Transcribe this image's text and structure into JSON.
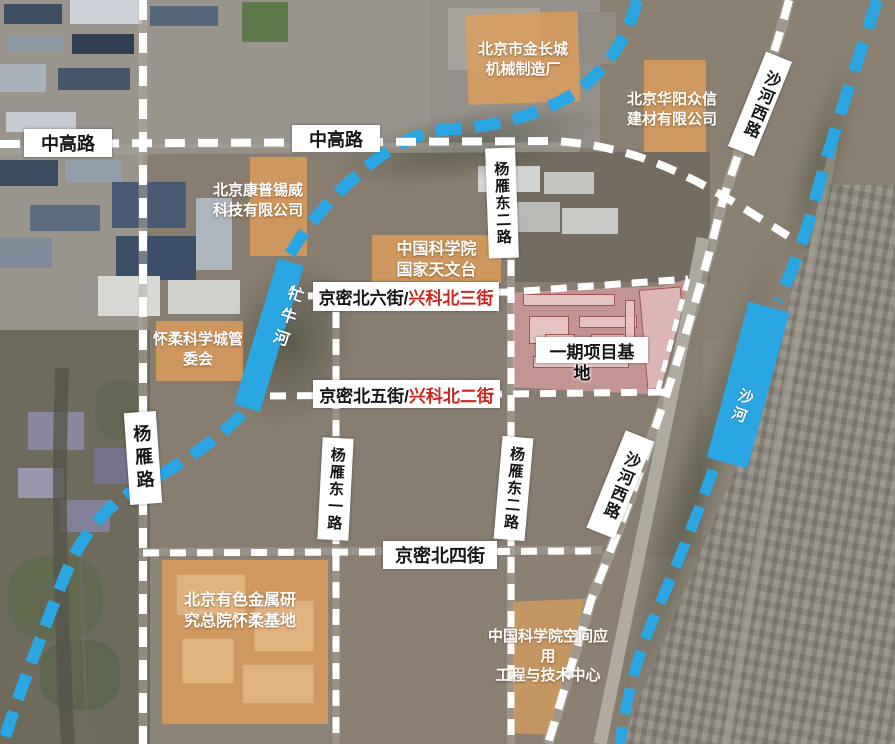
{
  "colors": {
    "river_blue": "#2aa7e3",
    "highlight_orange": "#e09e5a",
    "project_pink": "#d5a0a0",
    "road_label_red": "#c8281e",
    "road_dash_white": "#ffffff"
  },
  "road_labels": {
    "zhonggao_left": "中高路",
    "zhonggao_right": "中高路",
    "shahe_west_top": "沙河西路",
    "shahe_west_bottom": "沙河西路",
    "yangyan_dong_er_top": "杨雁东二路",
    "yangyan_dong_er_bottom": "杨雁东二路",
    "yangyan_dong_yi": "杨雁东一路",
    "yangyan": "杨雁路",
    "jingmi_liu_black": "京密北六街/",
    "jingmi_liu_red": "兴科北三街",
    "jingmi_wu_black": "京密北五街/",
    "jingmi_wu_red": "兴科北二街",
    "jingmi_si": "京密北四街"
  },
  "rivers": {
    "mangniu": "牤牛河",
    "shahe": "沙河"
  },
  "sites": {
    "jinchangcheng": "北京市金长城\n机械制造厂",
    "huayang": "北京华阳众信\n建材有限公司",
    "kangpu": "北京康普锡威\n科技有限公司",
    "observatory": "中国科学院\n国家天文台",
    "committee": "怀柔科学城管\n委会",
    "project_base_line1": "一期项目基",
    "project_base_line2": "地",
    "nonferrous": "北京有色金属研\n究总院怀柔基地",
    "space_center": "中国科学院空间应\n用\n工程与技术中心"
  }
}
